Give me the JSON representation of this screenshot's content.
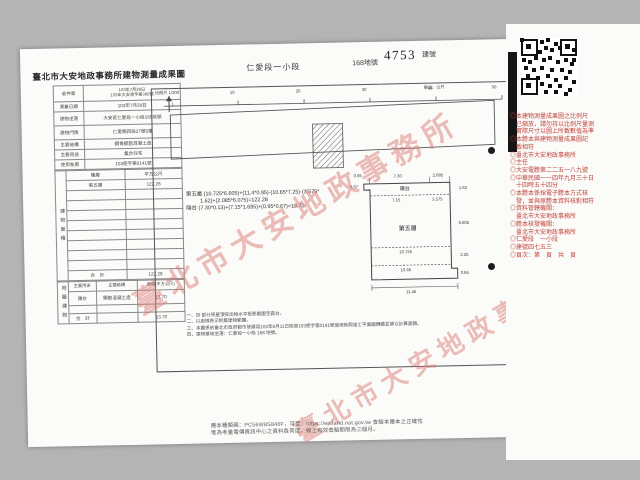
{
  "colors": {
    "page_bg": "#b4b4b4",
    "paper": "#fbfbf9",
    "ink": "#3a3a3a",
    "stamp_red": "#c0443c",
    "watermark_pink": "#dd8f8b"
  },
  "header": {
    "title": "臺北市大安地政事務所建物測量成果圖",
    "section": "仁愛段一小段",
    "lot": "168地號",
    "building_no": "4753",
    "building_no_label": "建號"
  },
  "form": {
    "receipt_label": "收件章",
    "receipt_line1": "103年7月29日",
    "receipt_line2": "103年大安測字第300號",
    "survey_date_label": "測量日期",
    "survey_date": "103年7月29日",
    "location_label": "建物坐落",
    "location": "大安區仁愛段一小段168地號",
    "address_label": "建物門牌",
    "address": "仁愛路四段27號5樓",
    "structure_label": "主要結構",
    "structure": "鋼骨鋼筋混凝土造",
    "usage_label": "主要用途",
    "usage": "集合住宅",
    "license_label": "使用執照",
    "license": "103使字第0141號"
  },
  "area_table": {
    "side_label": "建物面積",
    "col_floor": "樓層",
    "col_unit": "平方公尺",
    "floor_name": "第五層",
    "floor_area": "122.28",
    "total_label": "合　計",
    "total": "122.28"
  },
  "annex_table": {
    "side_label": "附屬建物",
    "col_usage": "主要用途",
    "col_structure": "主要結構",
    "col_area": "面積(平方公尺)",
    "row_usage": "陽台",
    "row_structure": "鋼筋混凝土造",
    "row_area": "13.70",
    "total_label": "合　計",
    "total": "13.70"
  },
  "plan": {
    "scale_note": "比例尺 1/300",
    "unit_note": "單位：公尺",
    "scale_ticks": [
      "10",
      "20",
      "30",
      "40",
      "50"
    ],
    "formula_line1": "第五層 (10.725*6.605)+(11.4*0.95)-(10.65*7.25)-(3.575*",
    "formula_line2": "1.62)+(2.085*6.075)=122.28",
    "formula_line3": "陽台 (7.30*0.13)+(7.15*1.695)+(0.95*0.67)=13.70",
    "balcony_label": "陽台",
    "floor_label": "第五層",
    "dims": {
      "d095": "0.95",
      "d067": "0.67",
      "d730": "7.30",
      "d2085": "2.085",
      "d162": "1.62",
      "d715": "7.15",
      "d3575": "3.575",
      "d6605": "6.605",
      "d10725": "10.725",
      "d225": "2.25",
      "d1065": "10.65",
      "d084": "0.84",
      "d1145": "11.45"
    },
    "notes": [
      "一、▨ 部分係屋頂突出物水平投影範圍至露台。",
      "二、以虛線表示附屬建物範圍。",
      "三、本圖係依臺北市政府都市發展局103年9月11日核發103使字第0141號使用執照竣工平面圖轉繪並據以計算面積。",
      "四、建物基地坐落：仁愛段一小段 168 地號。"
    ]
  },
  "watermark": {
    "text": "臺北市大安地政事務所"
  },
  "red_stamp": {
    "lines": [
      "◎本建物測量成果圖之比例尺",
      "　已縮放，請勿持以比例尺量測",
      "　實際尺寸以圖上所載數值為準",
      "◎本謄本與建物測量成果圖記",
      "　載相符",
      "◎臺北市大安地政事務所",
      "◎主任",
      "◎大安電謄第二二五一八九號",
      "◎中華民國一一四年九月三十日",
      "　十四時五十四分",
      "◎本謄本係採電子謄本方式核",
      "　發，並與原謄本資料核對相符",
      "◎資料管轄機關：",
      "　臺北市大安地政事務所",
      "◎謄本核發機關：",
      "　臺北市大安地政事務所",
      "◎仁愛段　一小段",
      "◎建號四七五三",
      "◎頁次：第　頁　共　頁"
    ]
  },
  "footer": {
    "line1": "謄本種類碼：PC56W8S846F，可至：https://ep.land.nat.gov.tw 查驗本謄本之正確性",
    "line2": "惟為考量電傳資訊中心之資料負荷度，線上有效查驗期限為三個月。"
  }
}
